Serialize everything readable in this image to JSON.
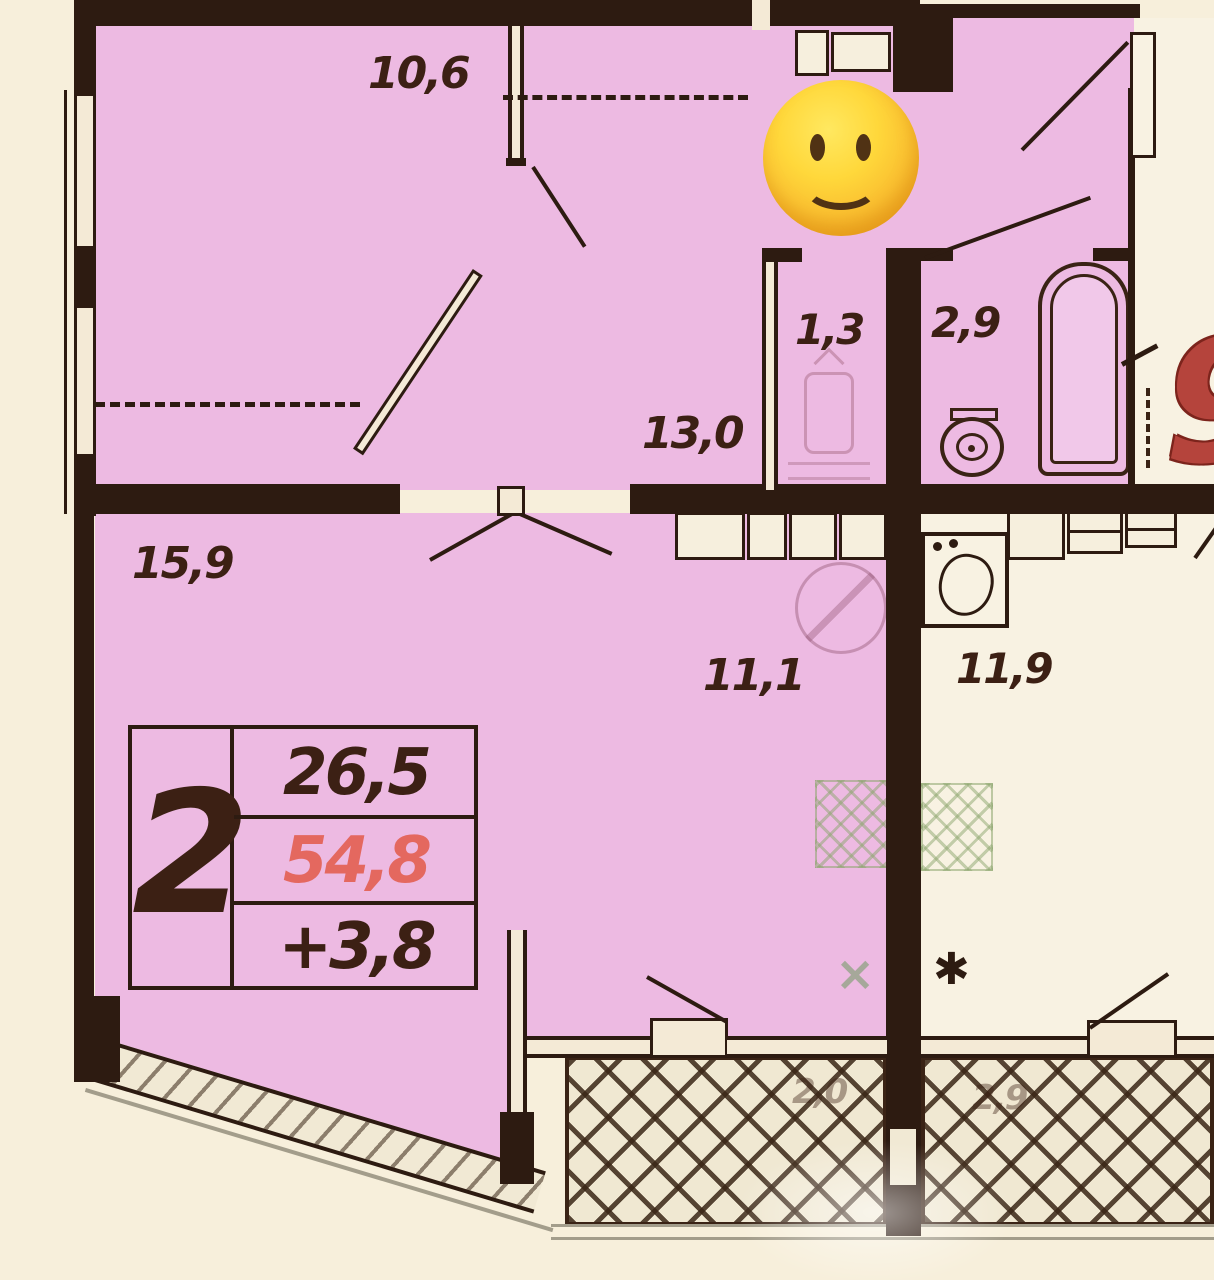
{
  "title": "2-room apartment floor plan",
  "unit_info": {
    "rooms_count": "2",
    "living_area": "26,5",
    "total_area": "54,8",
    "extra_area": "+3,8"
  },
  "room_areas": {
    "bedroom": "10,6",
    "storage": "1,3",
    "bathroom": "2,9",
    "hallway": "13,0",
    "living_room": "15,9",
    "kitchen_dining": "11,1",
    "kitchen": "11,9",
    "balcony_left": "2,0",
    "balcony_right": "2,9"
  },
  "marks": {
    "corner_number": "9",
    "asterisk": "✱",
    "cross": "×"
  },
  "colors": {
    "room_fill": "#edbae2",
    "wall": "#2d1b11",
    "paper": "#f7efdb",
    "highlight_red": "#e4685f",
    "corner_number_red": "#b5443c",
    "stove_hatch_green": "#9cb284"
  }
}
